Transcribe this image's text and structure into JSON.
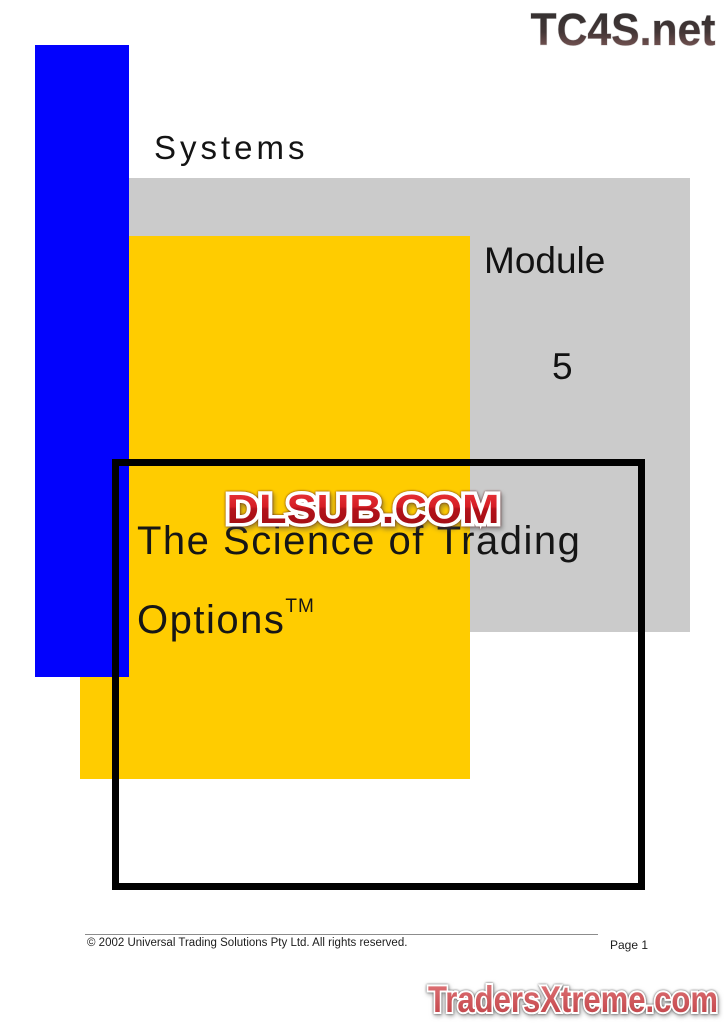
{
  "watermarks": {
    "tc4s_logo": "TC4S.net",
    "dlsub_logo": "DLSUB.COM",
    "tradersxtreme_logo": "TradersXtreme.com"
  },
  "cover": {
    "series_label": "Systems",
    "module_label": "Module",
    "module_number": "5",
    "title_line1": "The Science of Trading",
    "title_line2": "Options",
    "title_trademark": "TM"
  },
  "footer": {
    "copyright": "© 2002 Universal Trading Solutions Pty Ltd. All rights reserved.",
    "page_label": "Page 1"
  },
  "colors": {
    "accent_blue": "#0202FD",
    "accent_yellow": "#FFCC00",
    "panel_gray": "#CBCBCB",
    "frame_black": "#010101",
    "dlsub_red": "#C9181E",
    "tradersxtreme_red": "#CE5257",
    "tc4s_dark": "#2B2B2B"
  }
}
